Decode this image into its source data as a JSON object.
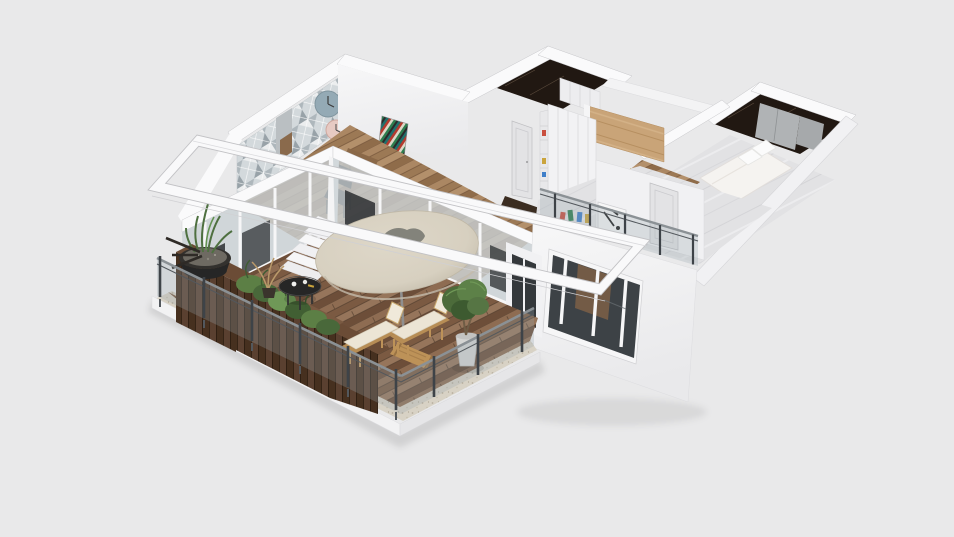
{
  "canvas": {
    "width": 954,
    "height": 537
  },
  "scene": {
    "type": "3d-floorplan-render",
    "background": "#e9e9ea"
  },
  "palette": {
    "background": "#e9e9ea",
    "wall_white": "#fafafb",
    "wall_light": "#f1f1f3",
    "wall_shade": "#e0e0e3",
    "wall_outline": "#c7c7ca",
    "deck_wood": "#85634a",
    "deck_seam": "#564130",
    "stone_border": "#d8d2c5",
    "planter_wood": "#4f3726",
    "plant_green": "#5c7f45",
    "plant_green_dark": "#415f33",
    "umbrella_canopy": "#d7d0c0",
    "umbrella_shade": "#c4bcab",
    "umbrella_center": "#83837b",
    "coffee_table": "#262626",
    "branch_tan": "#b9996a",
    "lounger_frame": "#bd9258",
    "lounger_cushion": "#ece5d5",
    "pot_gray": "#d5d5d3",
    "trunk_brown": "#6f5d46",
    "railing_glass": "rgba(150,166,173,0.28)",
    "railing_metal": "#8b9195",
    "railing_post": "#3e4348",
    "pergola_white": "#f9f9fa",
    "glass_pane": "#c9d1d4",
    "interior_dark": "#2c2f31",
    "interior_wood": "#a5825f",
    "oak_panel": "#c9a478",
    "gloss_floor": "#e2e2e4",
    "marble_dark": "#211812",
    "marble_vein": "#5a4a3c",
    "shower_glass": "#b0b3b5",
    "wardrobe_white": "#f2f2f4",
    "gold_decor": "#c6a13f",
    "door_gray": "#e3e3e5",
    "window_glass": "#3d4246",
    "window_brown": "#7d5f46",
    "bed_white": "#f5f3f0",
    "clock_blue": "#94aab5",
    "clock_pink": "#e7cac3",
    "mosaic_base": "#d3d9dc",
    "art_white": "#f6f6f6",
    "shadow": "rgba(0,0,0,0.10)"
  },
  "objects": {
    "viewport": "3d floor plan perspective view",
    "balcony": [
      "wood-deck",
      "glass-railing",
      "planter-boxes",
      "bowl-planter",
      "patio-umbrella",
      "coffee-table",
      "sun-loungers",
      "potted-tree",
      "pergola-frame",
      "steps"
    ],
    "living_room": [
      "mosaic-accent-wall",
      "wall-clocks",
      "chevron-artwork",
      "dining-chair",
      "sliding-glass-walls"
    ],
    "hallway": [
      "wardrobe",
      "oak-ceiling-panel",
      "hallway-door",
      "gold-decor-panel"
    ],
    "rooms": [
      "marble-closet-room",
      "marble-bathroom",
      "bedroom-with-bed",
      "front-room-with-railing"
    ],
    "exterior": [
      "white-volume-with-window",
      "roof-band"
    ]
  }
}
